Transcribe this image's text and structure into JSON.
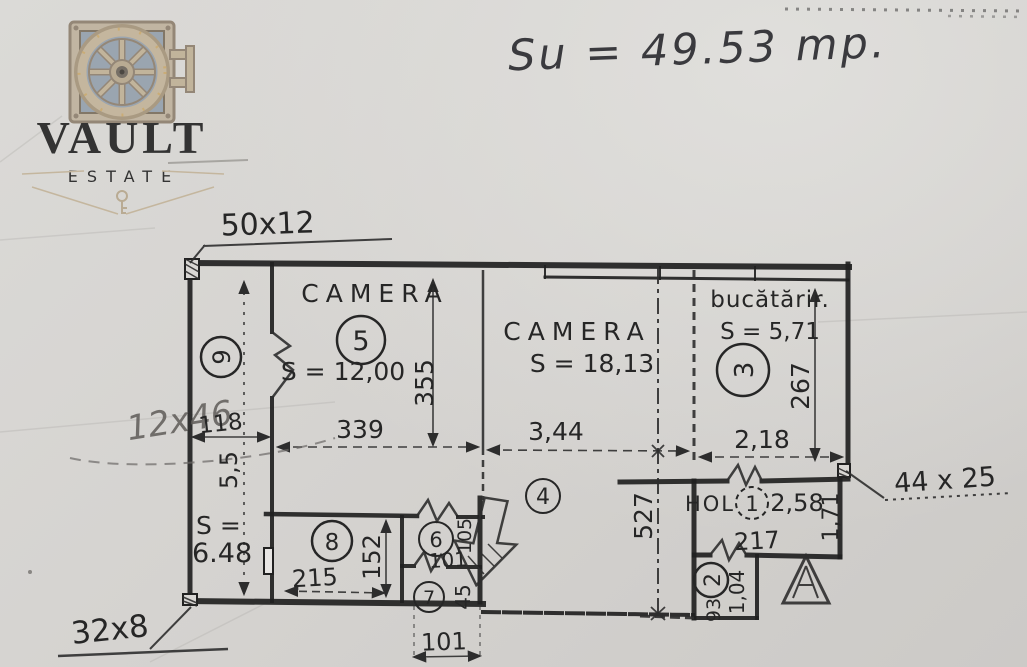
{
  "watermark": {
    "brand": "VAULT",
    "subtitle": "ESTATE"
  },
  "annotations": {
    "total_area": "Su = 49.53 mp.",
    "beam_top": "50x12",
    "beam_left": "12x46",
    "beam_right": "44 x 25",
    "beam_bottom": "32x8"
  },
  "rooms": {
    "balcony": {
      "number": "9",
      "area_label": "S =",
      "area_value": "6.48",
      "width": "118",
      "length": "5,5"
    },
    "camera5": {
      "name": "CAMERA",
      "number": "5",
      "area": "S = 12,00",
      "width": "339",
      "height": "355"
    },
    "camera4": {
      "name": "CAMERA",
      "number": "4",
      "area": "S = 18,13",
      "width": "3,44",
      "height": "527"
    },
    "kitchen": {
      "name": "bucătărir.",
      "number": "3",
      "area": "S = 5,71",
      "width": "2,18",
      "height": "267"
    },
    "hall": {
      "name": "HOL",
      "number": "1",
      "dim_a": "2,58",
      "dim_b": "1,71",
      "width": "217"
    },
    "room8": {
      "number": "8",
      "width": "215",
      "height": "152"
    },
    "room6": {
      "number": "6",
      "width": "101",
      "height": "105"
    },
    "room7": {
      "number": "7",
      "height": "45"
    },
    "room2": {
      "number": "2",
      "dim_a": "1,04",
      "dim_b": "93"
    }
  },
  "dimensions": {
    "bottom_width": "101"
  }
}
